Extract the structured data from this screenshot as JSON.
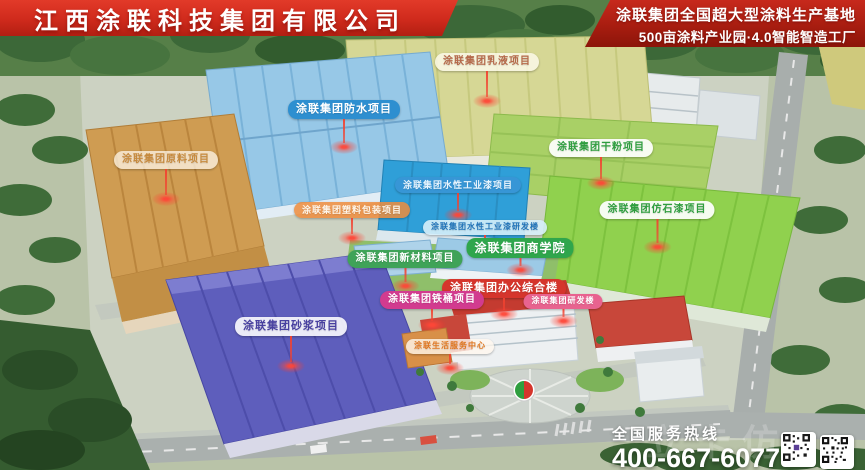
{
  "header": {
    "company_name": "江西涂联科技集团有限公司",
    "tagline_line1": "涂联集团全国超大型涂料生产基地",
    "tagline_line2": "500亩涂料产业园·4.0智能智造工厂"
  },
  "colors": {
    "banner_red": "#cf2a1c",
    "banner_dark_red": "#a81d10",
    "beacon_red": "#f24230",
    "logo_green": "#2f9e3f",
    "logo_red": "#d5352c"
  },
  "map_labels": [
    {
      "id": "emulsion",
      "text": "涂联集团乳液项目",
      "bg": "rgba(255,252,240,0.78)",
      "fg": "#b5694a"
    },
    {
      "id": "waterproof",
      "text": "涂联集团防水项目",
      "bg": "#2e8fd0",
      "fg": "#ffffff"
    },
    {
      "id": "raw-material",
      "text": "涂联集团原料项目",
      "bg": "rgba(255,250,238,0.72)",
      "fg": "#c68a3e"
    },
    {
      "id": "dry-powder",
      "text": "涂联集团干粉项目",
      "bg": "rgba(255,255,255,0.92)",
      "fg": "#2f9e3f"
    },
    {
      "id": "waterborne-industrial",
      "text": "涂联集团水性工业漆项目",
      "bg": "#3796d6",
      "fg": "#eaf6ff"
    },
    {
      "id": "plastic-packaging",
      "text": "涂联集团塑料包装项目",
      "bg": "rgba(238,140,60,0.85)",
      "fg": "#fff6ea"
    },
    {
      "id": "stone-paint",
      "text": "涂联集团仿石漆项目",
      "bg": "rgba(255,255,255,0.92)",
      "fg": "#2f9e3f"
    },
    {
      "id": "waterborne-rd",
      "text": "涂联集团水性工业漆研发楼",
      "bg": "rgba(214,238,250,0.9)",
      "fg": "#1f72b8"
    },
    {
      "id": "business-school",
      "text": "涂联集团商学院",
      "bg": "#2fa64c",
      "fg": "#ffffff"
    },
    {
      "id": "new-materials",
      "text": "涂联集团新材料项目",
      "bg": "#3fa358",
      "fg": "#ffffff"
    },
    {
      "id": "office-complex",
      "text": "涂联集团办公综合楼",
      "bg": "#d5352c",
      "fg": "#ffffff"
    },
    {
      "id": "iron-drum",
      "text": "涂联集团铁桶项目",
      "bg": "#d23b8f",
      "fg": "#ffffff"
    },
    {
      "id": "rd-building",
      "text": "涂联集团研发楼",
      "bg": "#e8638f",
      "fg": "#ffffff"
    },
    {
      "id": "mortar",
      "text": "涂联集团砂浆项目",
      "bg": "rgba(255,255,255,0.88)",
      "fg": "#4840a0"
    },
    {
      "id": "life-service",
      "text": "涂联生活服务中心",
      "bg": "rgba(255,248,238,0.8)",
      "fg": "#e0761f"
    }
  ],
  "footer": {
    "hotline_label": "全国服务热线",
    "hotline_number": "400-667-6077",
    "watermark": "立卡仿"
  }
}
